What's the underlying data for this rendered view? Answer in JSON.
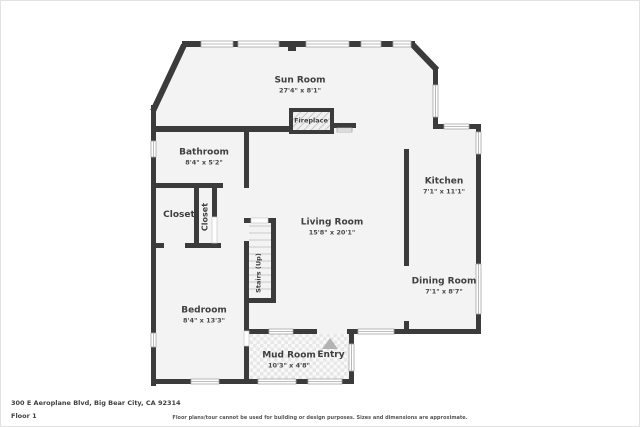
{
  "colors": {
    "wall": "#3b3b3b",
    "floor": "#f3f3f3",
    "label": "#3f3f3f",
    "arrow": "#b3b3b3"
  },
  "rooms": {
    "sun_room": {
      "name": "Sun Room",
      "dims": "27'4\" x 8'1\""
    },
    "bathroom": {
      "name": "Bathroom",
      "dims": "8'4\" x 5'2\""
    },
    "closet_left": {
      "name": "Closet"
    },
    "closet_inner": {
      "name": "Closet"
    },
    "living_room": {
      "name": "Living Room",
      "dims": "15'8\" x 20'1\""
    },
    "kitchen": {
      "name": "Kitchen",
      "dims": "7'1\" x 11'1\""
    },
    "dining_room": {
      "name": "Dining Room",
      "dims": "7'1\" x 8'7\""
    },
    "bedroom": {
      "name": "Bedroom",
      "dims": "8'4\" x 13'3\""
    },
    "mud_room": {
      "name": "Mud Room",
      "dims": "10'3\" x 4'8\""
    },
    "entry": {
      "name": "Entry"
    },
    "stairs": {
      "name": "Stairs (Up)"
    },
    "fireplace": {
      "name": "Fireplace"
    }
  },
  "footer": {
    "address": "300 E Aeroplane Blvd, Big Bear City, CA 92314",
    "floor": "Floor 1",
    "disclaimer": "Floor plans/tour cannot be used for building or design purposes. Sizes and dimensions are approximate."
  }
}
